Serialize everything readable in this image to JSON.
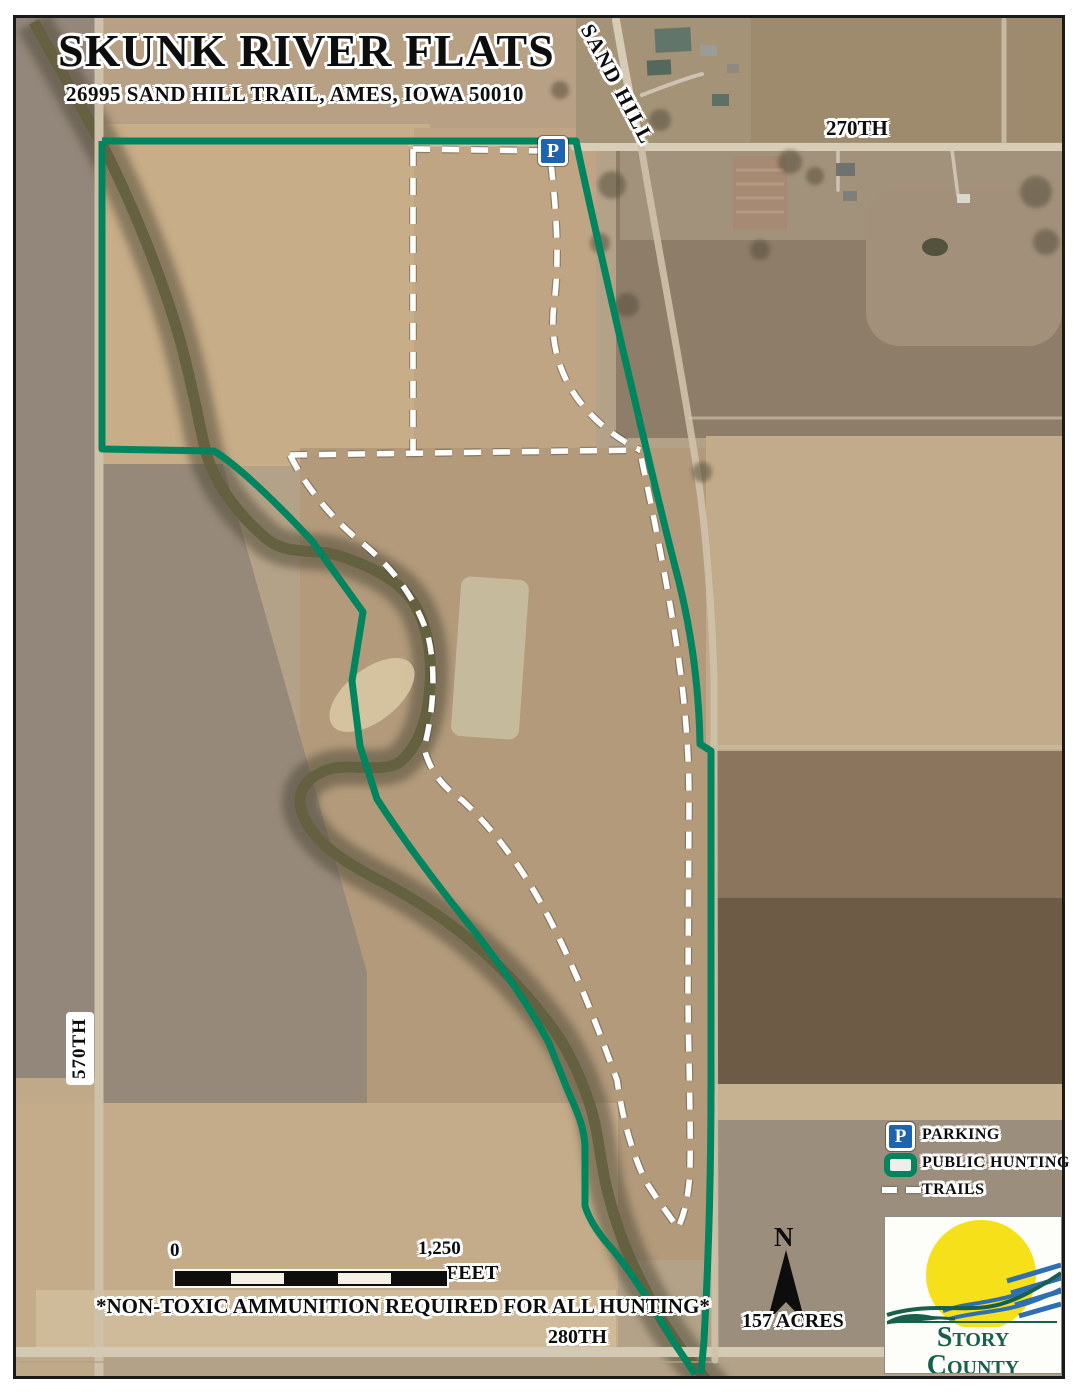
{
  "map": {
    "title": "SKUNK RIVER FLATS",
    "subtitle": "26995 SAND HILL TRAIL, AMES, IOWA 50010"
  },
  "roads": {
    "sand_hill": "SAND HILL",
    "road_270": "270TH",
    "road_570": "570TH",
    "road_280": "280TH"
  },
  "parking_sign": {
    "glyph": "P"
  },
  "legend": {
    "parking_glyph": "P",
    "parking_label": "PARKING",
    "public_hunting_label": "PUBLIC HUNTING",
    "trails_label": "TRAILS"
  },
  "scale_bar": {
    "start_label": "0",
    "end_label": "1,250",
    "unit_label": "FEET"
  },
  "annotations": {
    "hunting_note": "*NON-TOXIC AMMUNITION REQUIRED FOR ALL HUNTING*",
    "acreage": "157 ACRES",
    "north_label": "N"
  },
  "logo": {
    "org_line1": "Story County",
    "org_line2": "Conservation"
  },
  "colors": {
    "boundary_green": "#00855E",
    "trail_white": "#FFFFFF",
    "parking_blue": "#1D63AE",
    "logo_green": "#18604A",
    "logo_blue": "#2E6FB3",
    "sun_yellow": "#F5E01A"
  }
}
